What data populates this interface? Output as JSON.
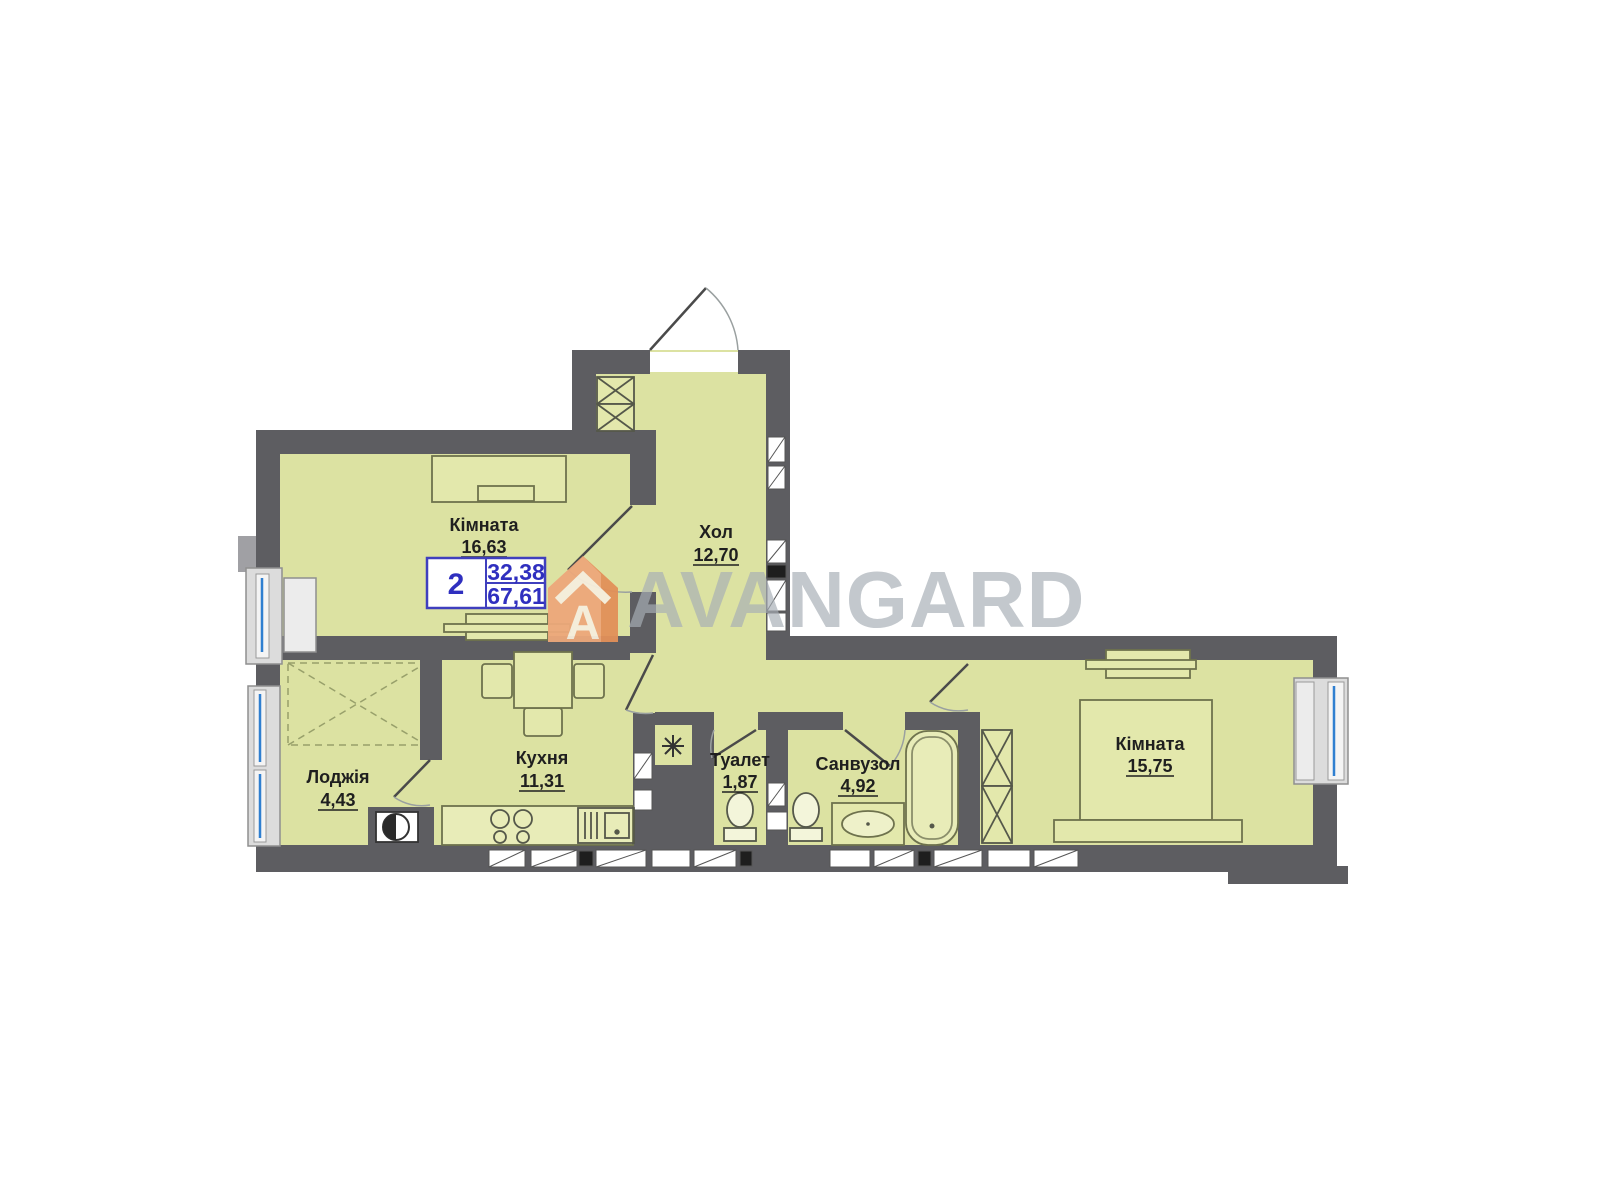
{
  "watermark": {
    "brand": "AVANGARD",
    "logo_letter": "A"
  },
  "badge": {
    "rooms": "2",
    "area_living": "32,38",
    "area_total": "67,61"
  },
  "rooms": [
    {
      "name": "Кімната",
      "area": "16,63"
    },
    {
      "name": "Хол",
      "area": "12,70"
    },
    {
      "name": "Кухня",
      "area": "11,31"
    },
    {
      "name": "Лоджія",
      "area": "4,43"
    },
    {
      "name": "Туалет",
      "area": "1,87"
    },
    {
      "name": "Санвузол",
      "area": "4,92"
    },
    {
      "name": "Кімната",
      "area": "15,75"
    }
  ],
  "symbols": {
    "boiler": "✳"
  },
  "colors": {
    "interior_fill": "#dce2a2",
    "wall": "#5d5d61",
    "badge_blue": "#3f3fbe",
    "watermark_gray": "#a7aeb6",
    "brand_orange": "#eda87b",
    "window_blue": "#2f7fd0"
  }
}
